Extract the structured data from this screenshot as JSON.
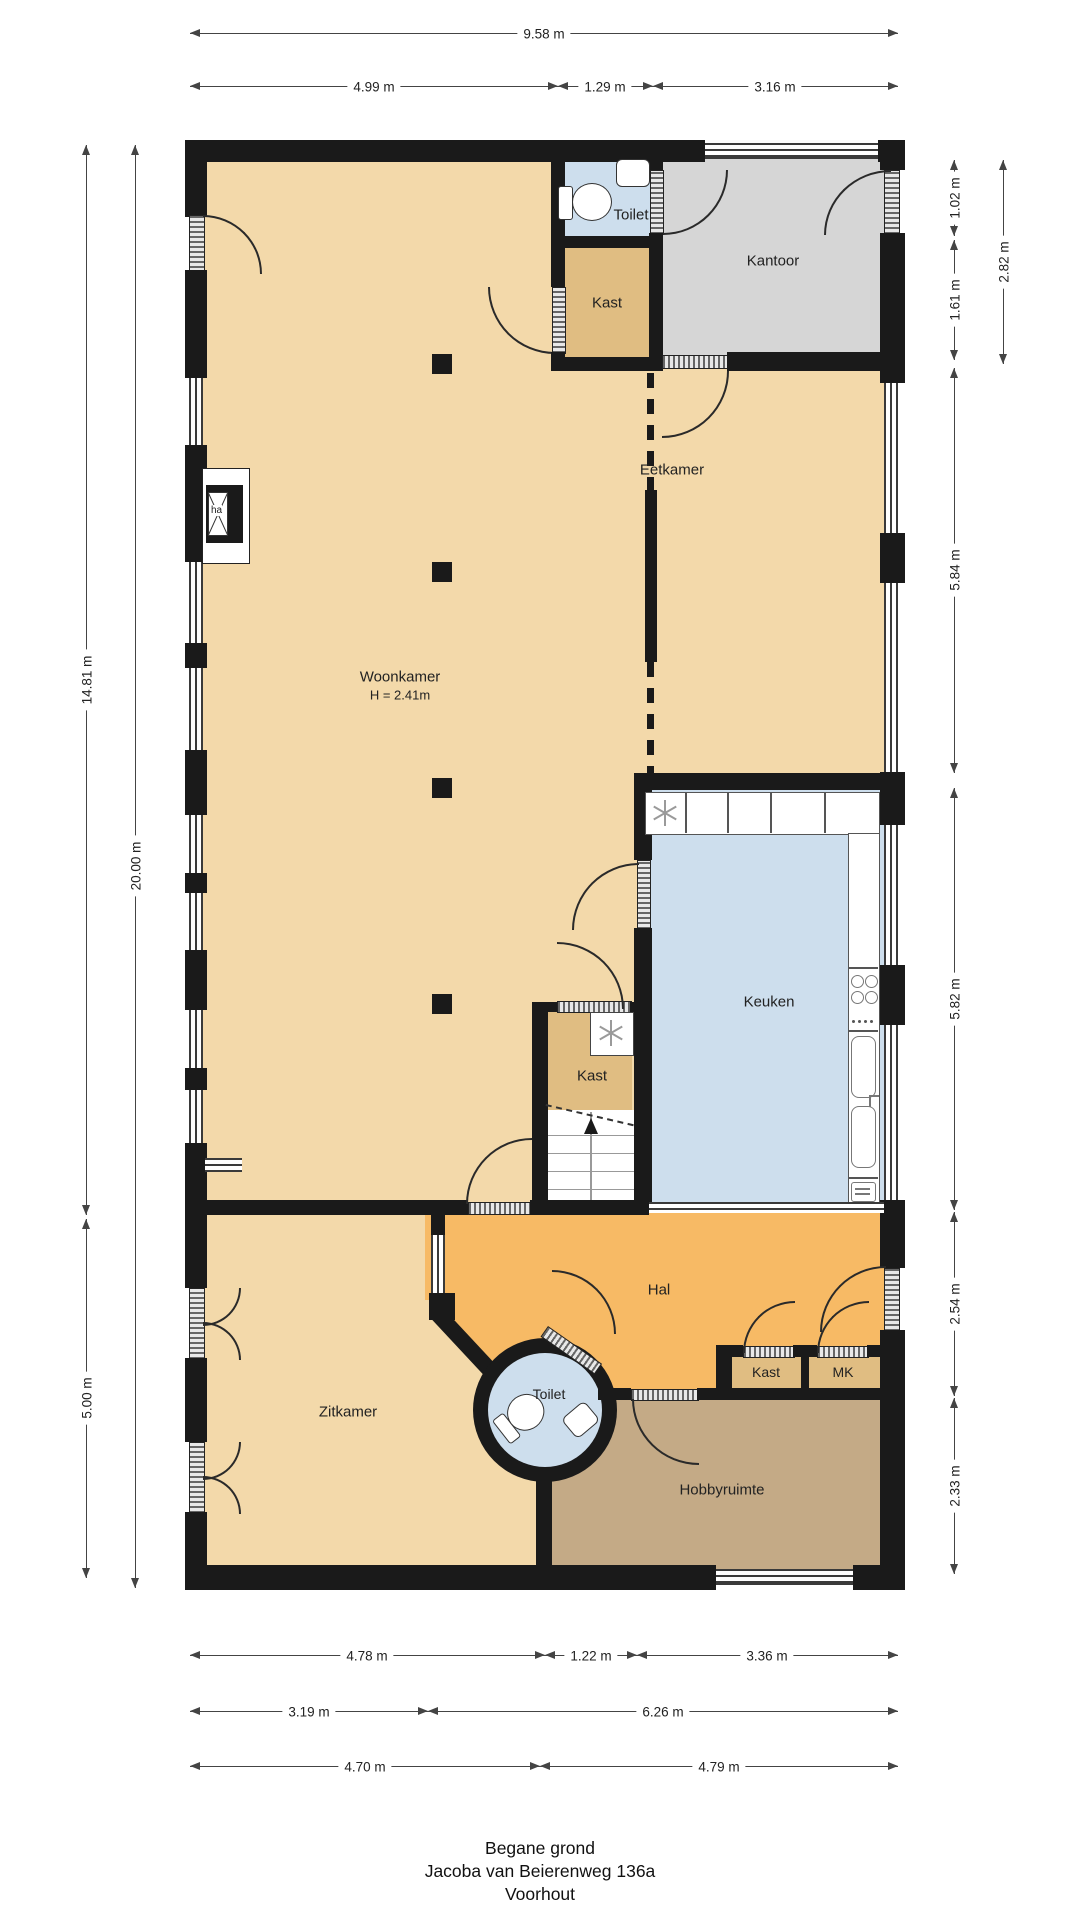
{
  "palette": {
    "floor_living": "#F3D9AA",
    "floor_closet": "#E0BD82",
    "floor_office": "#D6D6D6",
    "floor_wet": "#CDDEED",
    "floor_hall": "#F7BA65",
    "floor_hobby": "#C4AA86",
    "wall": "#1A1A1A"
  },
  "rooms": {
    "woonkamer": {
      "label": "Woonkamer",
      "note": "H = 2.41m"
    },
    "eetkamer": {
      "label": "Eetkamer"
    },
    "kantoor": {
      "label": "Kantoor"
    },
    "toilet_top": {
      "label": "Toilet"
    },
    "kast_top": {
      "label": "Kast"
    },
    "keuken": {
      "label": "Keuken"
    },
    "kast_mid": {
      "label": "Kast"
    },
    "hal": {
      "label": "Hal"
    },
    "zitkamer": {
      "label": "Zitkamer"
    },
    "toilet_round": {
      "label": "Toilet"
    },
    "kast_hal": {
      "label": "Kast"
    },
    "mk": {
      "label": "MK"
    },
    "hobbyruimte": {
      "label": "Hobbyruimte"
    },
    "fireplace": {
      "label": "ha"
    }
  },
  "dimensions": {
    "top_total": "9.58 m",
    "top": [
      "4.99 m",
      "1.29 m",
      "3.16 m"
    ],
    "left": [
      "14.81 m",
      "20.00 m",
      "5.00 m"
    ],
    "right": [
      "1.02 m",
      "2.82 m",
      "1.61 m",
      "5.84 m",
      "5.82 m",
      "2.54 m",
      "2.33 m"
    ],
    "bottom1": [
      "4.78 m",
      "1.22 m",
      "3.36 m"
    ],
    "bottom2": [
      "3.19 m",
      "6.26 m"
    ],
    "bottom3": [
      "4.70 m",
      "4.79 m"
    ]
  },
  "title": {
    "line1": "Begane grond",
    "line2": "Jacoba van Beierenweg 136a",
    "line3": "Voorhout"
  }
}
